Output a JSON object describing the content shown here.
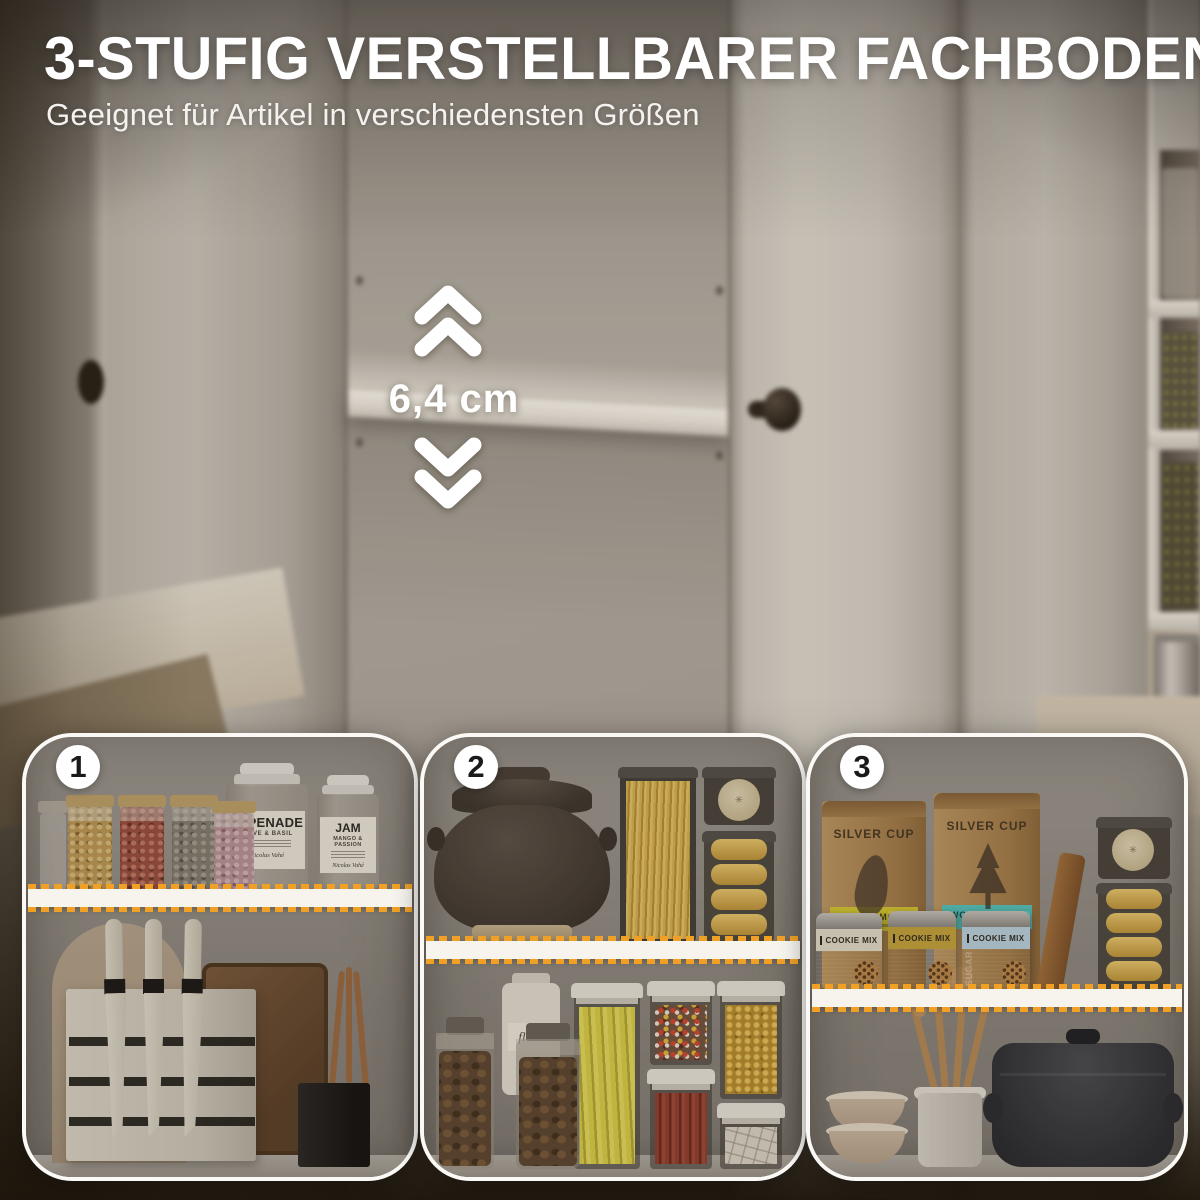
{
  "header": {
    "title": "3-STUFIG VERSTELLBARER FACHBODEN",
    "subtitle": "Geeignet für Artikel in verschiedensten Größen"
  },
  "annotation": {
    "measurement": "6,4 cm",
    "up_icon": "double-chevron-up",
    "down_icon": "double-chevron-down"
  },
  "colors": {
    "accent_orange": "#F0A125",
    "highlight_white": "#F7F4EE",
    "badge_background": "#FFFFFF",
    "badge_number": "#1A1A18",
    "title_text": "#FFFFFF",
    "label_yellow": "#D9CB35",
    "label_teal": "#57C7BF",
    "label_blue": "#BDD4E0",
    "vignette_brown": "#241B10"
  },
  "insets": [
    {
      "badge": "1",
      "items": {
        "tapenade_jar": {
          "label": "TAPENADE",
          "sublabel": "OLIVE & BASIL",
          "brand": "Nicolas Vahé"
        },
        "jam_jar": {
          "label": "JAM",
          "sublabel": "MANGO & PASSION",
          "brand": "Nicolas Vahé"
        }
      }
    },
    {
      "badge": "2",
      "items": {
        "flour_jar": {
          "label": "flour"
        }
      }
    },
    {
      "badge": "3",
      "items": {
        "bag_left": {
          "brand": "SILVER CUP",
          "label": "SNOHO MOJO"
        },
        "bag_right": {
          "brand": "SILVER CUP",
          "label": "WONDERLAND"
        },
        "tin_left": {
          "label": "COOKIE MIX"
        },
        "tin_middle": {
          "label": "COOKIE MIX"
        },
        "tin_right": {
          "label": "COOKIE MIX",
          "side_text": "SUGAR"
        }
      }
    }
  ]
}
